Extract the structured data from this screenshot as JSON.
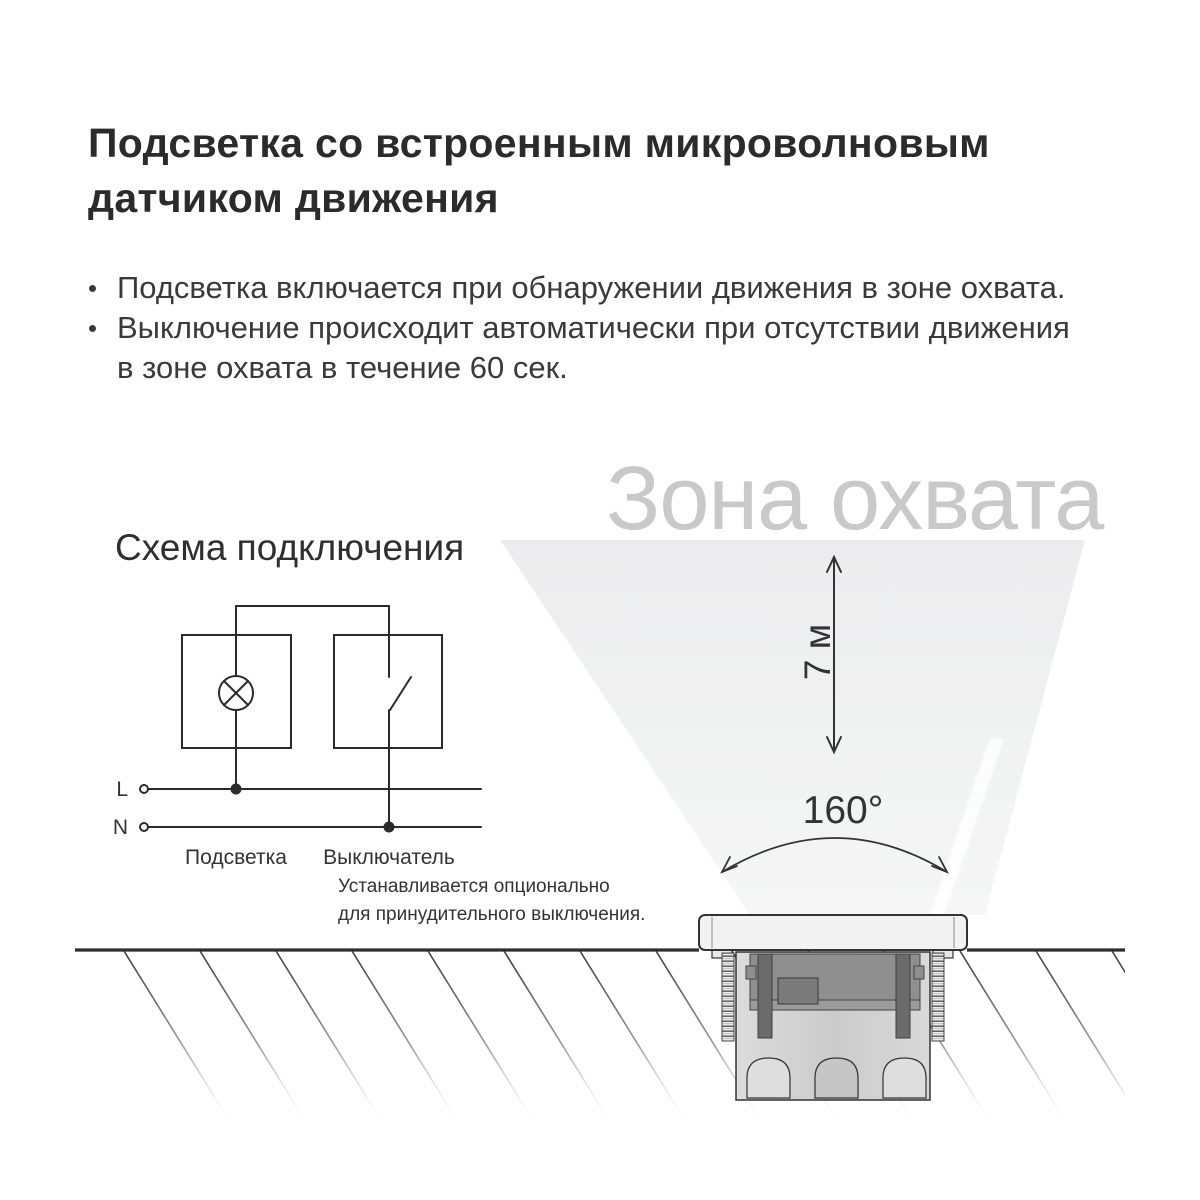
{
  "title": {
    "lines": [
      "Подсветка со встроенным микроволновым",
      "датчиком движения"
    ]
  },
  "bullets": [
    {
      "lines": [
        "Подсветка включается при обнаружении движения в зоне охвата."
      ]
    },
    {
      "lines": [
        "Выключение происходит автоматически при отсутствии движения",
        "в зоне охвата в течение 60 сек."
      ]
    }
  ],
  "wiring": {
    "heading": "Схема подключения",
    "line_labels": {
      "live": "L",
      "neutral": "N"
    },
    "component_labels": {
      "light": "Подсветка",
      "switch": "Выключатель"
    },
    "note_lines": [
      "Устанавливается опционально",
      "для принудительного выключения."
    ]
  },
  "coverage": {
    "watermark": "Зона охвата",
    "range_label": "7 м",
    "angle_label": "160°"
  },
  "colors": {
    "background": "#ffffff",
    "title_text": "#2b2b2e",
    "body_text": "#3a3a3a",
    "watermark_text": "#c9c9c9",
    "diagram_stroke": "#2b2b2b",
    "cone_fill_top": "#ececee",
    "cone_fill_bottom": "#f6f6f6",
    "ground_line": "#2f2f2f"
  }
}
